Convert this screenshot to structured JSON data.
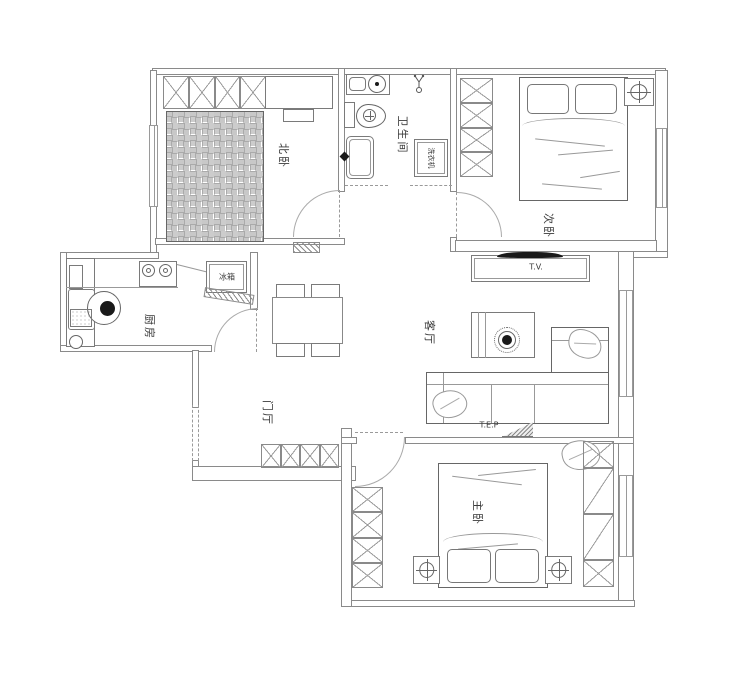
{
  "plan": {
    "type": "apartment-floor-plan"
  },
  "rooms": {
    "north_bedroom": {
      "label": "北卧"
    },
    "bathroom": {
      "label": "卫生间"
    },
    "second_bedroom": {
      "label": "次卧"
    },
    "kitchen": {
      "label": "厨房"
    },
    "living_room": {
      "label": "客厅"
    },
    "entry_hall": {
      "label": "门厅"
    },
    "master_bedroom": {
      "label": "主卧"
    }
  },
  "fixtures": {
    "washing_machine": {
      "label": "洗衣机"
    },
    "fridge": {
      "label": "冰箱"
    },
    "tv": {
      "label": "T.V."
    },
    "electrical_panel": {
      "label": "T.E.P"
    }
  },
  "colors": {
    "wall_line": "#8a8a8a",
    "furniture_line": "#7a7a7a",
    "text": "#3a3a3a",
    "background": "#ffffff",
    "accent_black": "#1a1a1a"
  }
}
